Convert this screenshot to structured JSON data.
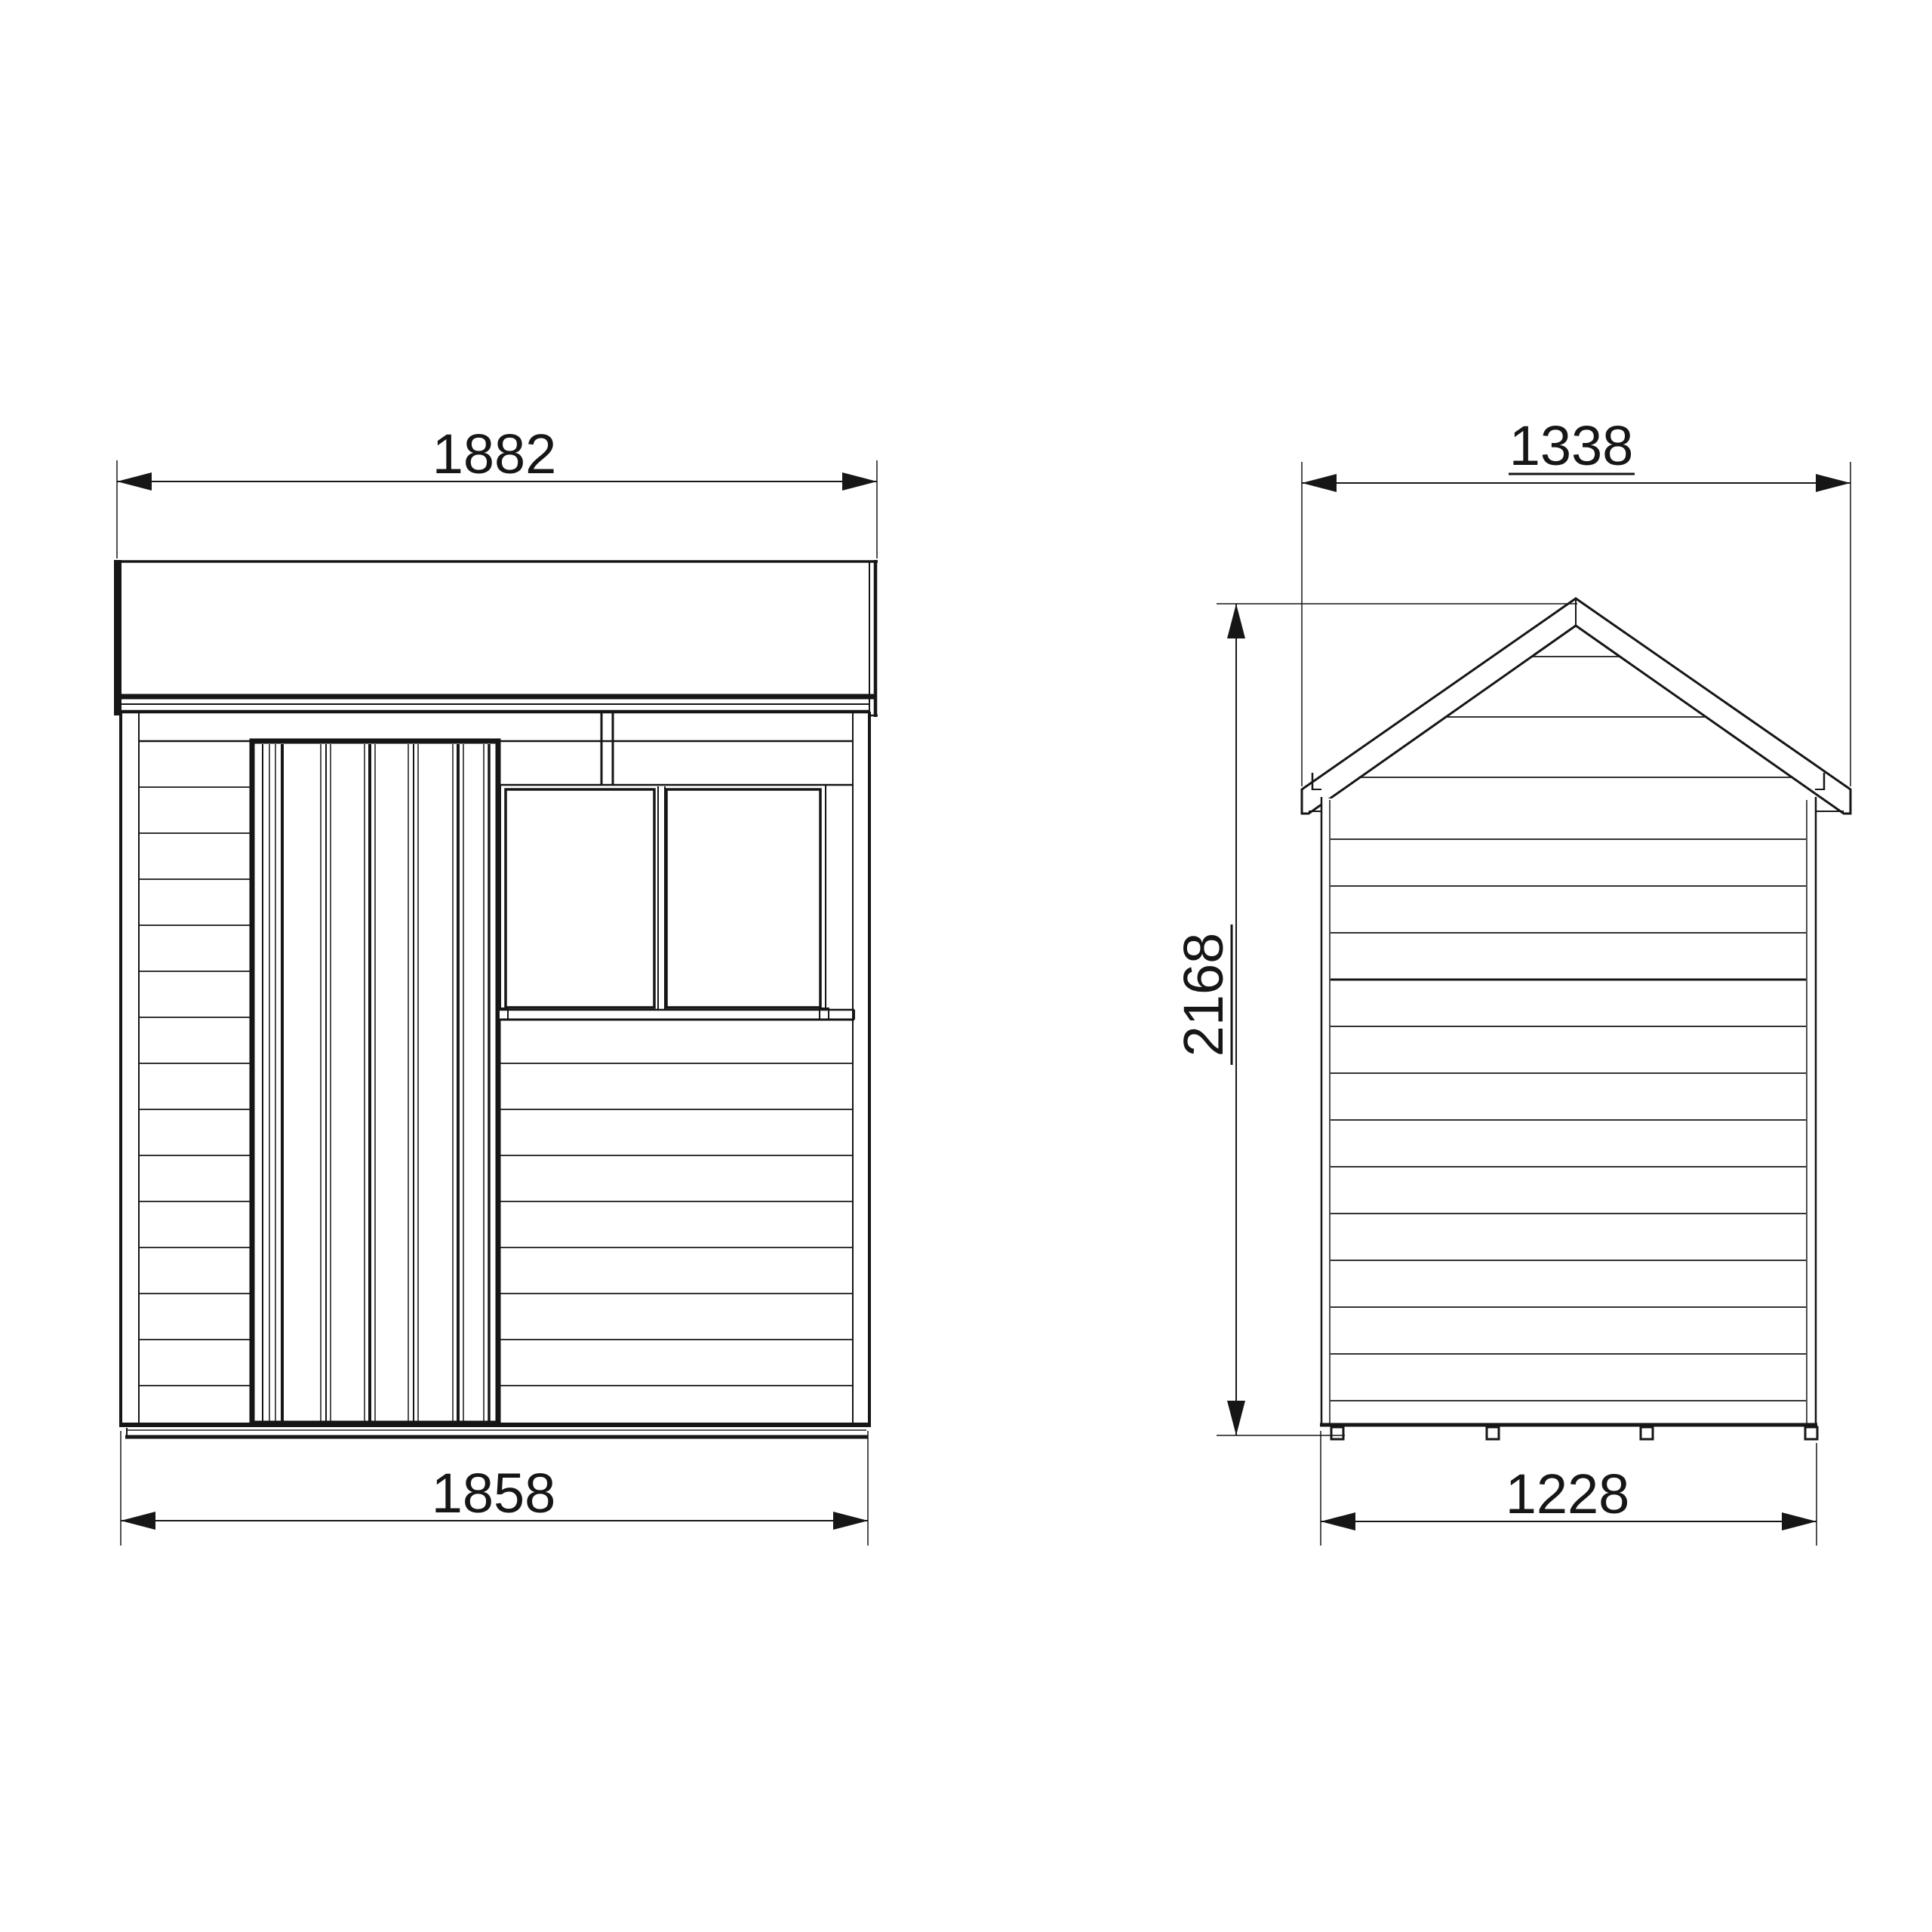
{
  "meta": {
    "drawing_type": "shed elevation technical drawing",
    "background_color": "#ffffff",
    "line_color": "#161616",
    "views": [
      "front-elevation",
      "side-elevation"
    ]
  },
  "views": {
    "front": {
      "title": "front-elevation",
      "features": [
        "roof-fascia",
        "ledged-door",
        "double-window",
        "horizontal-cladding",
        "floor-bearer"
      ],
      "dimensions": {
        "roof_width": {
          "value": "1882",
          "underlined": false,
          "orientation": "horizontal"
        },
        "base_width": {
          "value": "1858",
          "underlined": false,
          "orientation": "horizontal"
        }
      }
    },
    "side": {
      "title": "side-elevation",
      "features": [
        "apex-roof",
        "gable-cladding",
        "horizontal-cladding",
        "floor-bearers"
      ],
      "dimensions": {
        "roof_width": {
          "value": "1338",
          "underlined": true,
          "orientation": "horizontal"
        },
        "base_width": {
          "value": "1228",
          "underlined": false,
          "orientation": "horizontal"
        },
        "height": {
          "value": "2168",
          "underlined": true,
          "orientation": "vertical-rotated"
        }
      }
    }
  }
}
